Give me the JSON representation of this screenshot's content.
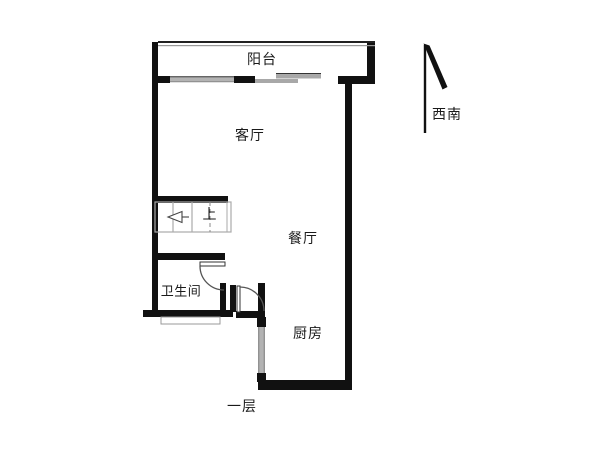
{
  "floor_plan": {
    "floor_label": "一层",
    "rooms": [
      {
        "id": "balcony",
        "label": "阳台"
      },
      {
        "id": "living-room",
        "label": "客厅"
      },
      {
        "id": "dining-room",
        "label": "餐厅"
      },
      {
        "id": "bathroom",
        "label": "卫生间"
      },
      {
        "id": "kitchen",
        "label": "厨房"
      }
    ],
    "stairs": {
      "direction_label": "上"
    },
    "compass": {
      "direction_label": "西南"
    },
    "colors": {
      "wall": "#111111",
      "window_fill": "#b3b3b3",
      "stair_line": "#aaaaaa",
      "door_line": "#555555",
      "text": "#1a1a1a"
    }
  }
}
